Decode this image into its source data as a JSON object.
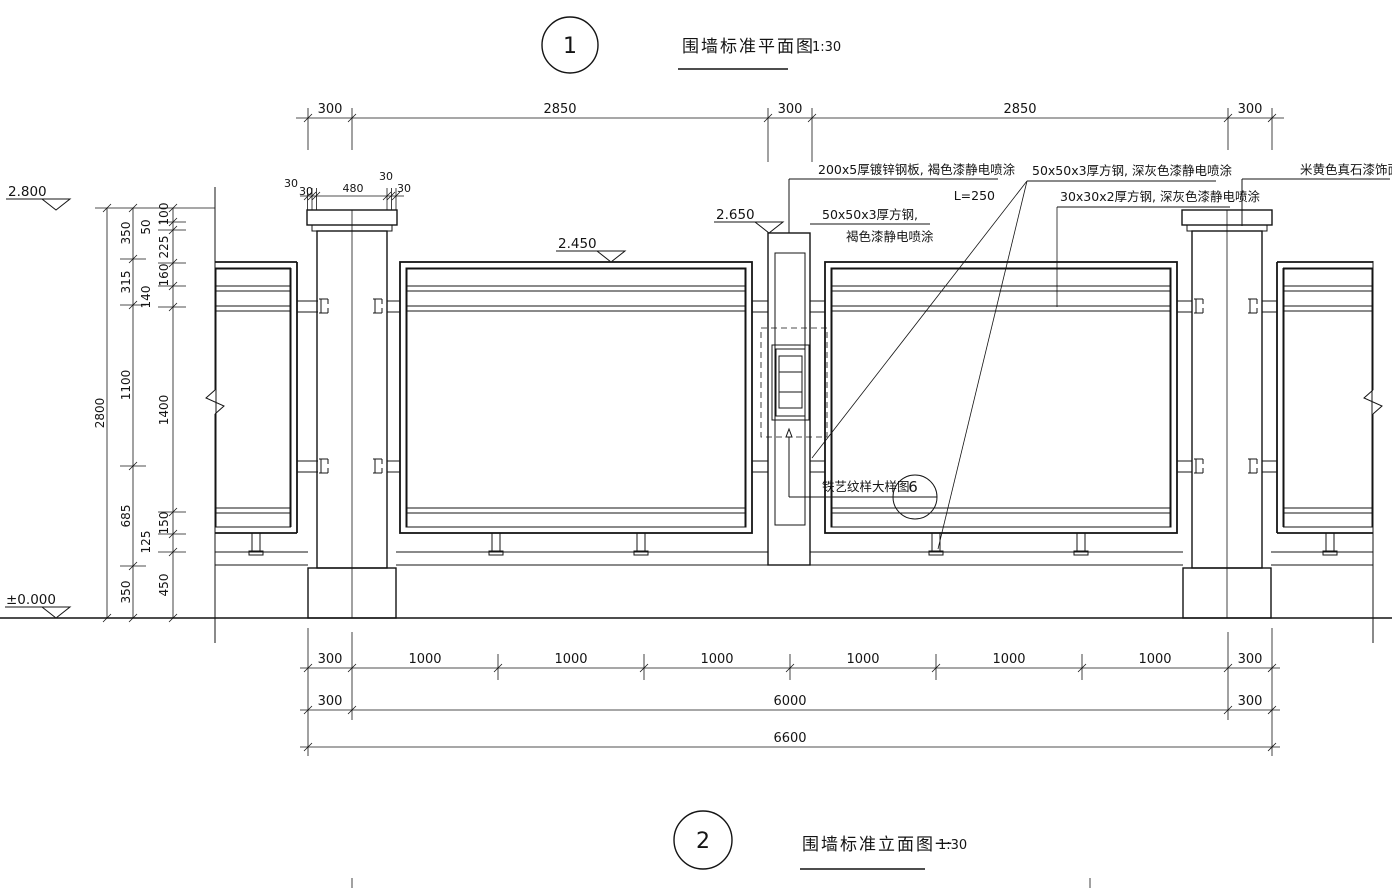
{
  "titles": {
    "view1": {
      "number": "1",
      "name": "围墙标准平面图",
      "scale": "1:30"
    },
    "view2": {
      "number": "2",
      "name": "围墙标准立面图一",
      "scale": "1:30"
    }
  },
  "elevations": {
    "wall_top": "2.800",
    "gate_post_top": "2.650",
    "panel_top": "2.450",
    "ground": "±0.000"
  },
  "annotations": {
    "galvanized_plate": "200x5厚镀锌钢板, 褐色漆静电喷涂",
    "galvanized_plate_length": "L=250",
    "square_steel_brown_line1": "50x50x3厚方钢,",
    "square_steel_brown_line2": "褐色漆静电喷涂",
    "square_steel_gray": "50x50x3厚方钢, 深灰色漆静电喷涂",
    "square_steel_small": "30x30x2厚方钢, 深灰色漆静电喷涂",
    "stone_paint": "米黄色真石漆饰面",
    "iron_detail_label": "铁艺纹样大样图",
    "iron_detail_ref": "6"
  },
  "dims": {
    "top": [
      "300",
      "2850",
      "300",
      "2850",
      "300"
    ],
    "pillar_cap": [
      "30",
      "30",
      "480",
      "30",
      "30"
    ],
    "bottom_bays": [
      "300",
      "1000",
      "1000",
      "1000",
      "1000",
      "1000",
      "1000",
      "300"
    ],
    "bottom_mid": [
      "300",
      "6000",
      "300"
    ],
    "bottom_total": "6600",
    "left_outer": "2800",
    "left_middle": [
      "350",
      "315",
      "1100",
      "685",
      "350"
    ],
    "left_inner": [
      "100",
      "50",
      "225",
      "160",
      "140",
      "1400",
      "150",
      "125",
      "450"
    ]
  },
  "colors": {
    "line": "#141414",
    "paper": "#ffffff"
  }
}
